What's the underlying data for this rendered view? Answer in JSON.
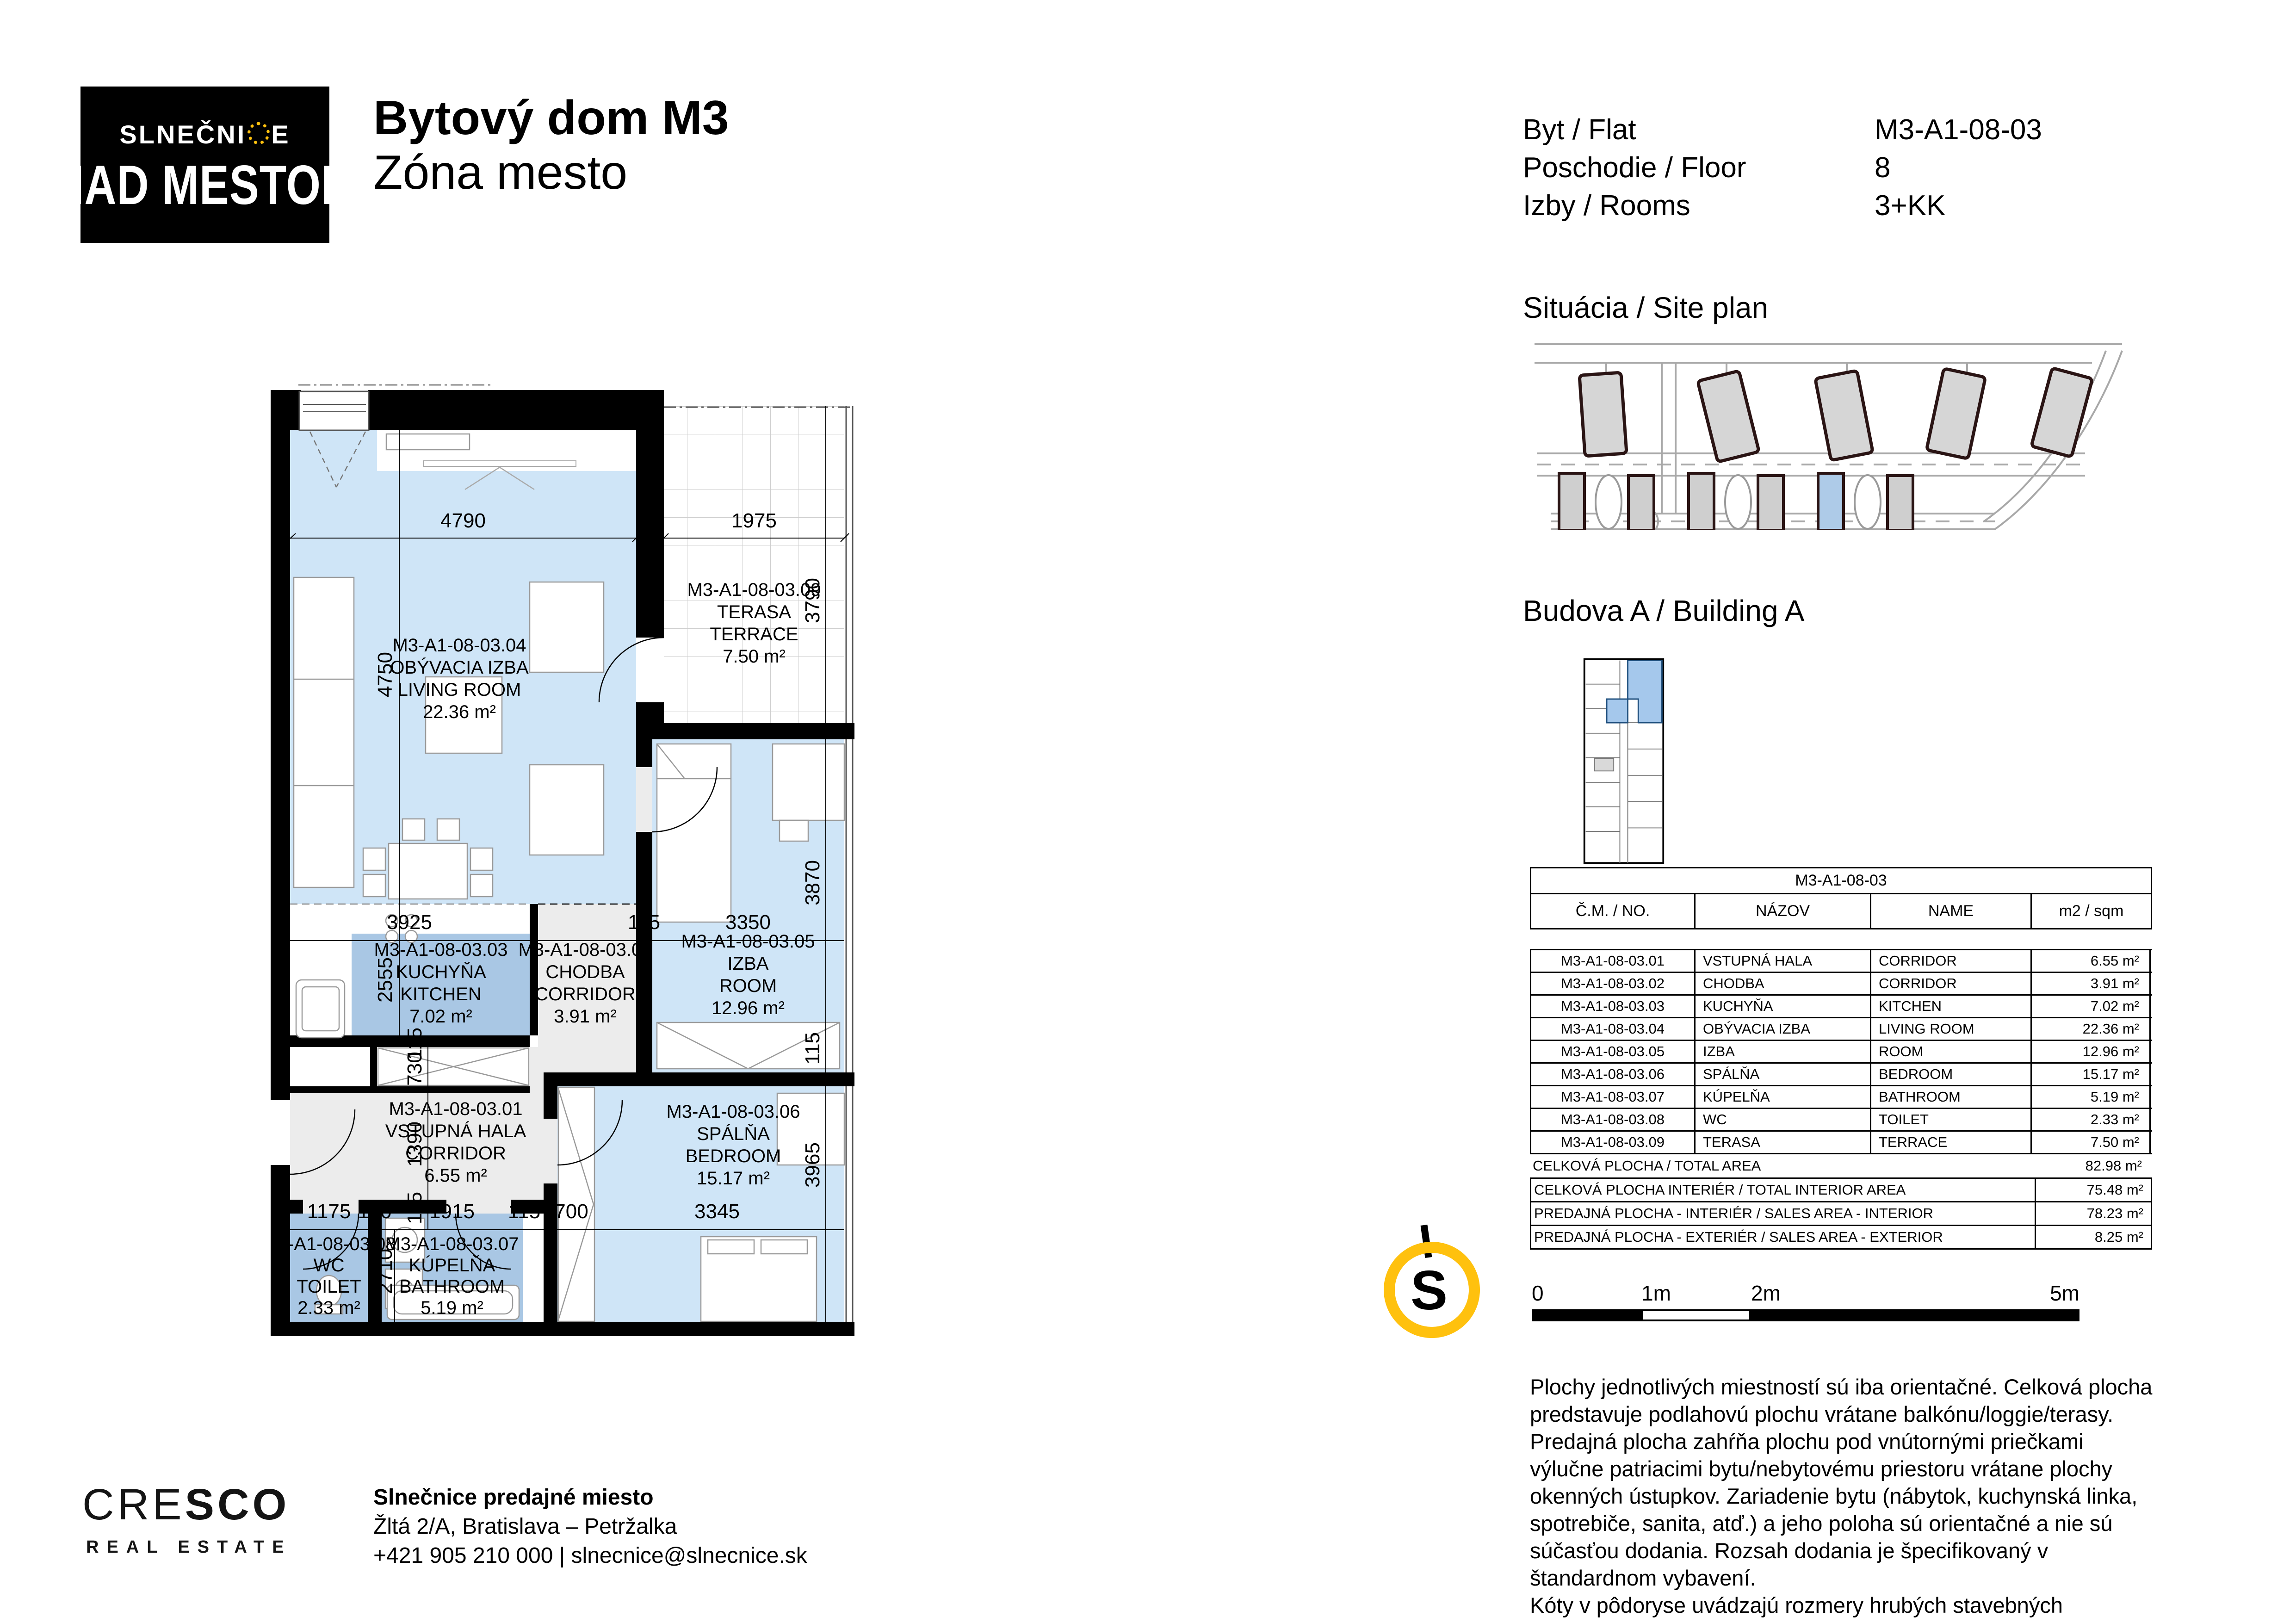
{
  "logo": {
    "brand_pre": "SLNEČNI",
    "brand_post": "E",
    "brand_line2": "NAD MESTOM"
  },
  "header": {
    "title": "Bytový dom M3",
    "subtitle": "Zóna mesto",
    "info": [
      {
        "label": "Byt / Flat",
        "value": "M3-A1-08-03"
      },
      {
        "label": "Poschodie / Floor",
        "value": "8"
      },
      {
        "label": "Izby / Rooms",
        "value": "3+KK"
      }
    ]
  },
  "sections": {
    "site_plan": "Situácia / Site plan",
    "building": "Budova A / Building A"
  },
  "rooms": [
    {
      "code": "M3-A1-08-03.01",
      "sk": "VSTUPNÁ HALA",
      "en": "CORRIDOR",
      "area": "6.55 m²"
    },
    {
      "code": "M3-A1-08-03.02",
      "sk": "CHODBA",
      "en": "CORRIDOR",
      "area": "3.91 m²"
    },
    {
      "code": "M3-A1-08-03.03",
      "sk": "KUCHYŇA",
      "en": "KITCHEN",
      "area": "7.02 m²"
    },
    {
      "code": "M3-A1-08-03.04",
      "sk": "OBÝVACIA IZBA",
      "en": "LIVING ROOM",
      "area": "22.36 m²"
    },
    {
      "code": "M3-A1-08-03.05",
      "sk": "IZBA",
      "en": "ROOM",
      "area": "12.96 m²"
    },
    {
      "code": "M3-A1-08-03.06",
      "sk": "SPÁLŇA",
      "en": "BEDROOM",
      "area": "15.17 m²"
    },
    {
      "code": "M3-A1-08-03.07",
      "sk": "KÚPELŇA",
      "en": "BATHROOM",
      "area": "5.19 m²"
    },
    {
      "code": "M3-A1-08-03.08",
      "sk": "WC",
      "en": "TOILET",
      "area": "2.33 m²"
    },
    {
      "code": "M3-A1-08-03.09",
      "sk": "TERASA",
      "en": "TERRACE",
      "area": "7.50 m²"
    }
  ],
  "dims": [
    "4790",
    "1975",
    "4750",
    "3790",
    "3925",
    "115",
    "3350",
    "2555",
    "3870",
    "115",
    "730",
    "1390",
    "115",
    "1175",
    "140",
    "1915",
    "115",
    "700",
    "3345",
    "3965",
    "2710",
    "115"
  ],
  "table": {
    "title": "M3-A1-08-03",
    "headers": [
      "Č.M. / NO.",
      "NÁZOV",
      "NAME",
      "m2 / sqm"
    ],
    "totals": [
      {
        "label": "CELKOVÁ PLOCHA / TOTAL AREA",
        "value": "82.98 m²"
      },
      {
        "label": "CELKOVÁ PLOCHA INTERIÉR / TOTAL INTERIOR AREA",
        "value": "75.48 m²"
      },
      {
        "label": "PREDAJNÁ PLOCHA - INTERIÉR / SALES AREA - INTERIOR",
        "value": "78.23 m²"
      },
      {
        "label": "PREDAJNÁ PLOCHA - EXTERIÉR / SALES AREA - EXTERIOR",
        "value": "8.25 m²"
      }
    ]
  },
  "compass": {
    "letter": "S"
  },
  "scalebar": {
    "labels": [
      "0",
      "1m",
      "2m",
      "5m"
    ]
  },
  "disclaimer": [
    "Plochy jednotlivých miestností sú iba orientačné. Celková plocha predstavuje podlahovú plochu vrátane balkónu/loggie/terasy.",
    "Predajná plocha zahŕňa plochu pod vnútornými priečkami výlučne patriacimi bytu/nebytovému priestoru vrátane plochy okenných ústupkov. Zariadenie bytu (nábytok, kuchynská linka, spotrebiče, sanita, atď.) a jeho poloha sú orientačné a nie sú súčasťou dodania. Rozsah dodania je špecifikovaný v štandardnom vybavení.",
    "Kóty v pôdoryse uvádzajú rozmery hrubých stavebných konštrukcií. Tieto konštrukcie budú po realizácii omietok a obkladov hrubšie o cca 20mm smerom do miestnosti. Svetlý rozmer miestnosti uvedený kótou bude teda menší o cca 40mm."
  ],
  "footer": {
    "logo_thin": "CRE",
    "logo_bold": "SCO",
    "logo_sub": "REAL ESTATE",
    "office": "Slnečnice predajné miesto",
    "address": "Žltá 2/A, Bratislava – Petržalka",
    "phone": "+421 905 210 000 | slnecnice@slnecnice.sk"
  },
  "colors": {
    "accent_yellow": "#FFC10E",
    "room_light_blue": "#CFE5F7",
    "room_medium_blue": "#A9C7E4",
    "room_gray": "#ECECEC",
    "wall_black": "#000000",
    "site_highlight": "#AECBE8"
  }
}
